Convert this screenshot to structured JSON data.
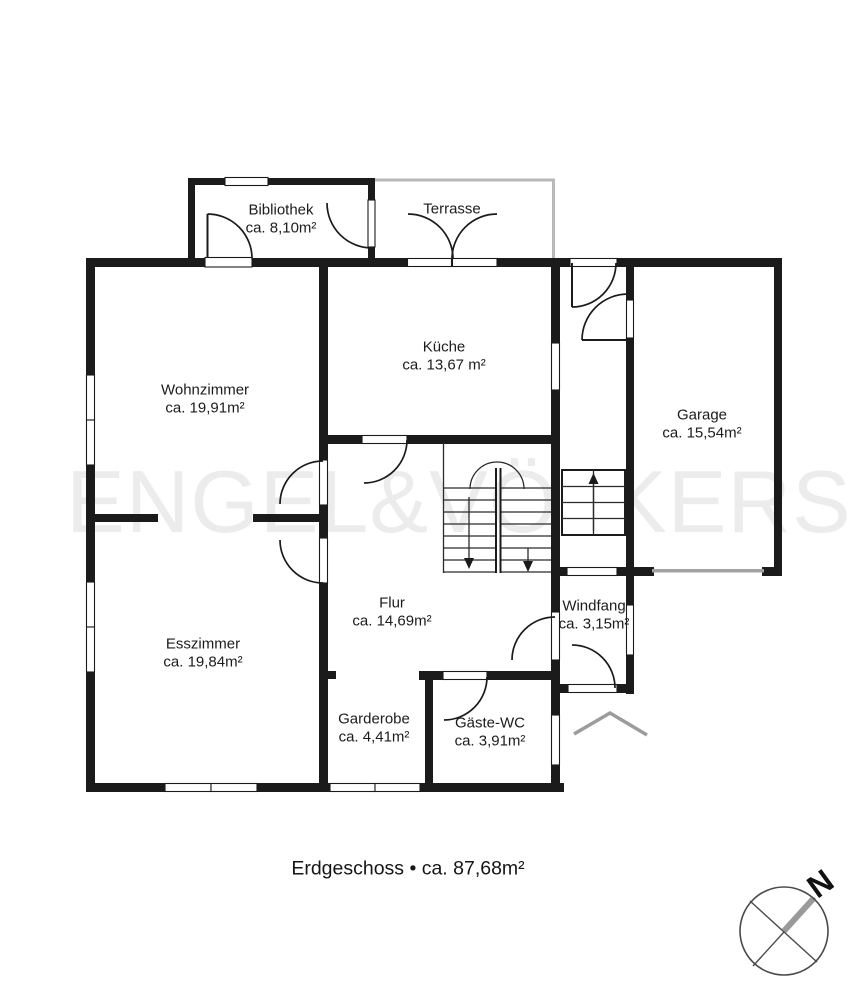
{
  "watermark": "ENGEL&VÖLKERS",
  "caption": "Erdgeschoss • ca. 87,68m²",
  "compass": {
    "north_label": "N"
  },
  "rooms": {
    "bibliothek": {
      "name": "Bibliothek",
      "area": "ca. 8,10m²"
    },
    "terrasse": {
      "name": "Terrasse"
    },
    "kueche": {
      "name": "Küche",
      "area": "ca. 13,67 m²"
    },
    "wohnzimmer": {
      "name": "Wohnzimmer",
      "area": "ca. 19,91m²"
    },
    "garage": {
      "name": "Garage",
      "area": "ca. 15,54m²"
    },
    "esszimmer": {
      "name": "Esszimmer",
      "area": "ca. 19,84m²"
    },
    "flur": {
      "name": "Flur",
      "area": "ca. 14,69m²"
    },
    "windfang": {
      "name": "Windfang",
      "area": "ca. 3,15m²"
    },
    "garderobe": {
      "name": "Garderobe",
      "area": "ca. 4,41m²"
    },
    "gaeste_wc": {
      "name": "Gäste-WC",
      "area": "ca. 3,91m²"
    }
  },
  "colors": {
    "wall": "#1b1b1b",
    "terrace_outline": "#bdbdbd",
    "canopy": "#9c9c9c",
    "garage_door": "#a3a3a3",
    "watermark": "#ececec"
  }
}
